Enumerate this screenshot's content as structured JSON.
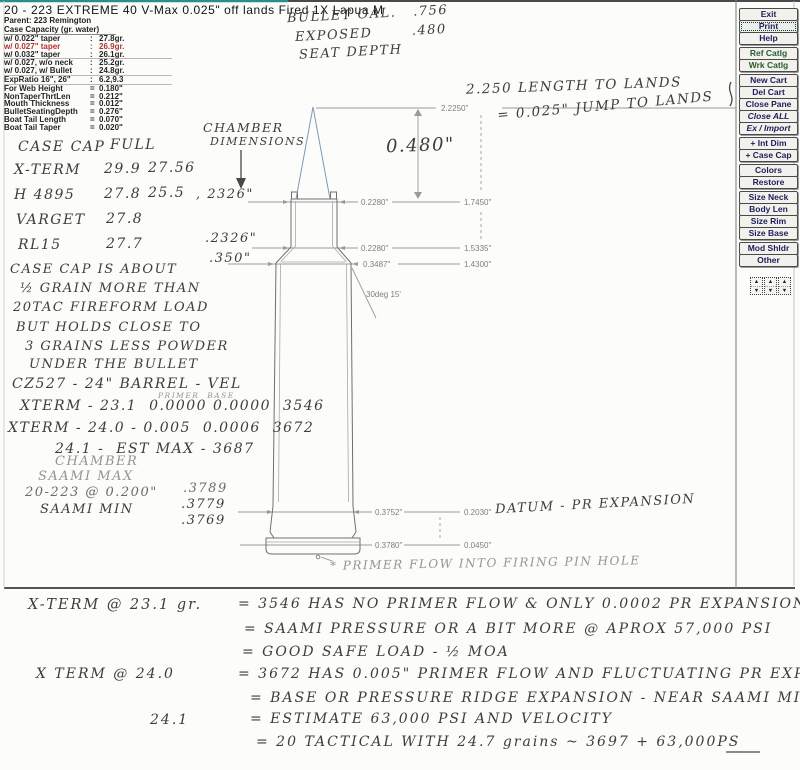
{
  "colors": {
    "accent_teal": "#2d8c8c",
    "highlight_red": "#b23434",
    "bullet_blue": "#7e9ab5"
  },
  "header": {
    "title": "20 - 223 EXTREME 40 V-Max 0.025\" off lands Fired 1X Lapua M",
    "parent": "Parent: 223 Remington",
    "capacity_heading": "Case Capacity (gr. water)"
  },
  "spec_rows": [
    {
      "label": "w/ 0.022\" taper",
      "sep": ":",
      "value": "27.8gr."
    },
    {
      "label": "w/ 0.027\" taper",
      "sep": ":",
      "value": "26.9gr."
    },
    {
      "label": "w/ 0.032\" taper",
      "sep": ":",
      "value": "26.1gr."
    },
    {
      "label": "w/ 0.027, w/o neck",
      "sep": ":",
      "value": "25.2gr."
    },
    {
      "label": "w/ 0.027, w/ Bullet",
      "sep": ":",
      "value": "24.8gr."
    },
    {
      "label": "ExpRatio 16\", 26\"",
      "sep": ":",
      "value": "6.2,9.3"
    },
    {
      "label": "For Web Height",
      "sep": "=",
      "value": "0.180\""
    },
    {
      "label": "NonTaperThrtLen",
      "sep": "=",
      "value": "0.212\""
    },
    {
      "label": "Mouth Thickness",
      "sep": "=",
      "value": "0.012\""
    },
    {
      "label": "BulletSeatingDepth",
      "sep": "=",
      "value": "0.276\""
    },
    {
      "label": "Boat Tail Length",
      "sep": "=",
      "value": "0.070\""
    },
    {
      "label": "Boat Tail Taper",
      "sep": "=",
      "value": "0.020\""
    }
  ],
  "toolbar": {
    "buttons": [
      "Exit",
      "Print",
      "Help",
      "Ref Catlg",
      "Wrk Catlg",
      "New Cart",
      "Del Cart",
      "Close Pane",
      "Close ALL",
      "Ex / Import",
      "+ Int Dim",
      "+ Case Cap",
      "Colors",
      "Restore",
      "Size Neck",
      "Body Len",
      "Size Rim",
      "Size Base",
      "Mod Shldr",
      "Other"
    ]
  },
  "icons": {
    "spinner_up": "▲",
    "spinner_down": "▼"
  },
  "diagram": {
    "oal": "2.2250\"",
    "rows": [
      {
        "dia": "0.2280\"",
        "len": "1.7450\""
      },
      {
        "dia": "0.2280\"",
        "len": "1.5335\""
      },
      {
        "dia": "0.3487\"",
        "len": "1.4300\""
      },
      {
        "dia": "0.3752\"",
        "len": "0.2030\""
      },
      {
        "dia": "0.3780\"",
        "len": "0.0450\""
      }
    ],
    "shoulder_angle": "30deg 15'"
  },
  "hw": {
    "bullet_oal": "BULLET OAL.   .756",
    "exposed": "EXPOSED       .480",
    "seat_depth": "SEAT DEPTH",
    "length_to_lands": "2.250 LENGTH TO LANDS",
    "jump_to_lands": "= 0.025\" JUMP TO LANDS",
    "chamber_l1": "CHAMBER",
    "chamber_l2": "DIMENSIONS",
    "exposed_dim": "0.480\"",
    "cap_table": {
      "h1": "CASE CAP",
      "h2": "FULL",
      "rows": [
        {
          "name": "X-TERM",
          "full": "29.9",
          "fired": "27.56"
        },
        {
          "name": "H 4895",
          "full": "27.8",
          "fired": "25.5"
        },
        {
          "name": "VARGET",
          "full": "27.8",
          "fired": ""
        },
        {
          "name": "RL15",
          "full": "27.7",
          "fired": ""
        }
      ]
    },
    "neck1": ", 2326\"",
    "neck2": ".2326\"",
    "neck3": ".350\"",
    "case_cap_note": [
      "CASE CAP IS ABOUT",
      "½ GRAIN MORE THAN",
      "20TAC FIREFORM LOAD",
      "BUT HOLDS CLOSE TO",
      "3 GRAINS LESS POWDER",
      "UNDER THE BULLET"
    ],
    "vel_note": {
      "l1": "CZ527 - 24\" BARREL - VEL",
      "mini": "PRIMER  BASE",
      "l2": "XTERM - 23.1  0.0000 0.0000  3546",
      "l3": "XTERM - 24.0 - 0.005  0.0006  3672",
      "l4": "24.1 -  EST MAX - 3687"
    },
    "chamber_note": {
      "l1": "CHAMBER",
      "l2": "SAAMI MAX",
      "l3": "20-223 @ 0.200\"",
      "l4": "SAAMI MIN",
      "v1": ".3789",
      "v2": ".3779",
      "v3": ".3769"
    },
    "datum": "DATUM - PR EXPANSION",
    "primer_flow": "* PRIMER FLOW INTO FIRING PIN HOLE",
    "summary": {
      "l1a": "X-TERM @ 23.1 gr.",
      "l1b": "= 3546 HAS NO PRIMER FLOW & ONLY 0.0002 PR EXPANSION",
      "l2": "= SAAMI PRESSURE OR A BIT MORE @ APROX 57,000 PSI",
      "l3": "= GOOD SAFE LOAD - ½ MOA",
      "l4a": "X TERM @ 24.0",
      "l4b": "= 3672 HAS 0.005\" PRIMER FLOW AND FLUCTUATING PR EXPANSION",
      "l5": "= BASE OR PRESSURE RIDGE EXPANSION - NEAR SAAMI MIN.",
      "l6a": "24.1",
      "l6b": "= ESTIMATE 63,000 PSI AND VELOCITY",
      "l7": "= 20 TACTICAL WITH 24.7 grains ~ 3697 + 63,000PS"
    }
  }
}
